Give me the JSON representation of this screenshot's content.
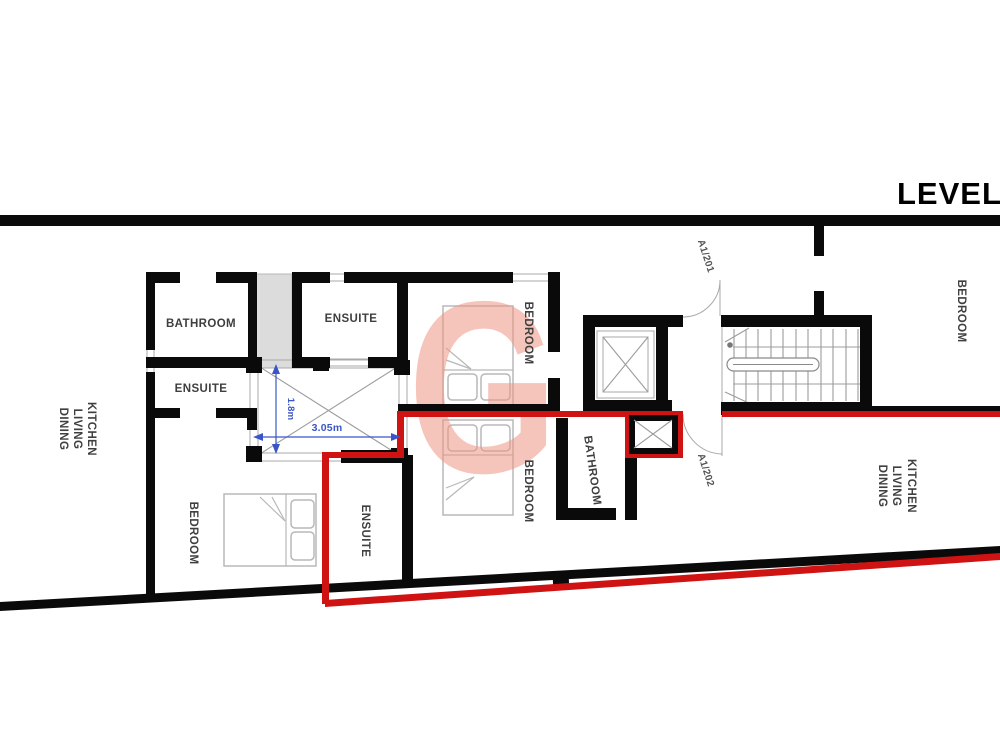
{
  "title": {
    "level_label": "LEVEL"
  },
  "watermark": {
    "letter": "G"
  },
  "rooms": {
    "bathroom_top_left": "BATHROOM",
    "ensuite_top": "ENSUITE",
    "ensuite_mid_left": "ENSUITE",
    "bedroom_center_upper": "BEDROOM",
    "bedroom_center_lower": "BEDROOM",
    "bathroom_center": "BATHROOM",
    "bedroom_bottom_left": "BEDROOM",
    "ensuite_bottom": "ENSUITE",
    "bedroom_top_right": "BEDROOM"
  },
  "kitchen_living_dining_left": {
    "kitchen": "KITCHEN",
    "living": "LIVING",
    "dining": "DINING"
  },
  "kitchen_living_dining_right": {
    "kitchen": "KITCHEN",
    "living": "LIVING",
    "dining": "DINING"
  },
  "door_tags": {
    "a1_201": "A1/201",
    "a1_202": "A1/202"
  },
  "dimensions": {
    "void_width": "3.05m",
    "void_height": "1.8m"
  },
  "colors": {
    "wall_black": "#0a0a0a",
    "boundary_red": "#cf1212",
    "dimension_blue": "#3b55c9",
    "shaft_gray": "#dcdcdc",
    "watermark_pink": "#ee9583"
  }
}
